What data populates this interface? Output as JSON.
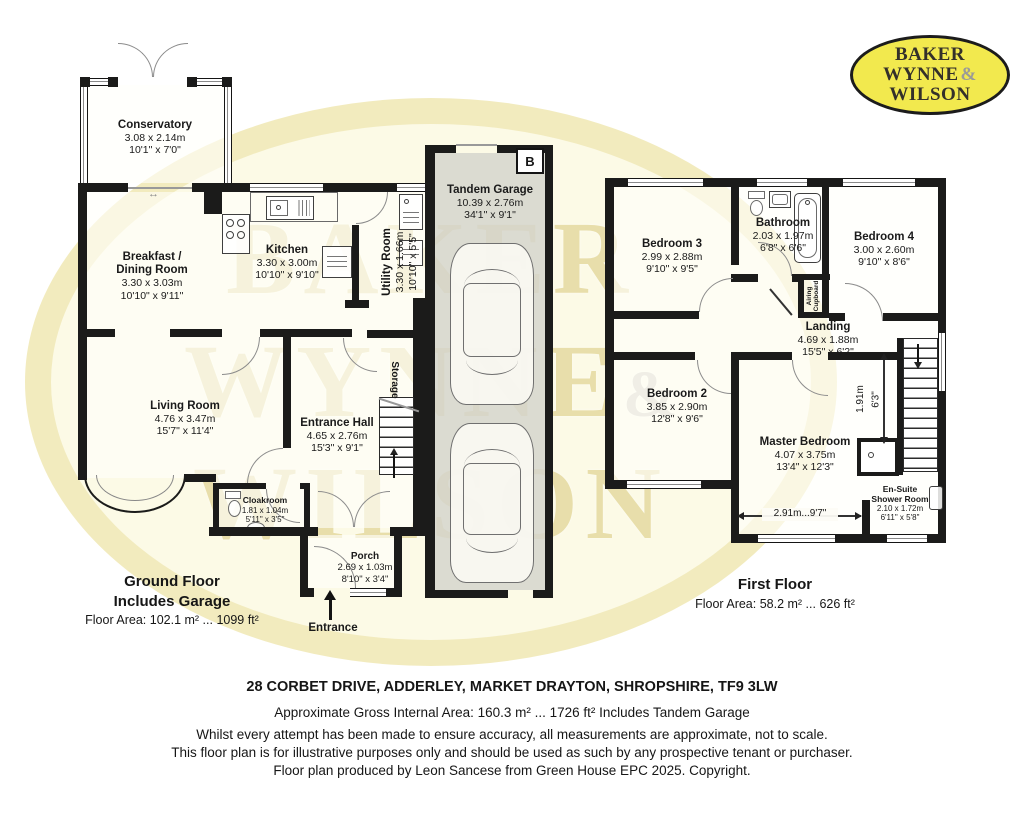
{
  "logo": {
    "line1": "BAKER",
    "line2": "WYNNE",
    "ampersand": "&",
    "line3": "WILSON"
  },
  "watermark": {
    "line1": "BAKER",
    "line2": "WYNNE",
    "ampersand": "&",
    "line3": "WILSON"
  },
  "ground_floor": {
    "title": "Ground Floor",
    "subtitle": "Includes Garage",
    "area": "Floor Area: 102.1 m² ... 1099 ft²",
    "entrance_label": "Entrance",
    "storage_label": "Storage",
    "boiler_label": "B",
    "sliding_door_icon": "↔",
    "rooms": [
      {
        "name": "Conservatory",
        "dim_m": "3.08 x 2.14m",
        "dim_ft": "10'1\" x 7'0\""
      },
      {
        "name": "Breakfast /\nDining Room",
        "dim_m": "3.30 x 3.03m",
        "dim_ft": "10'10\" x 9'11\""
      },
      {
        "name": "Kitchen",
        "dim_m": "3.30 x 3.00m",
        "dim_ft": "10'10\" x 9'10\""
      },
      {
        "name": "Utility Room",
        "dim_m": "3.30 x 1.66m",
        "dim_ft": "10'10\" x 5'5\""
      },
      {
        "name": "Living Room",
        "dim_m": "4.76 x 3.47m",
        "dim_ft": "15'7\" x 11'4\""
      },
      {
        "name": "Entrance Hall",
        "dim_m": "4.65 x 2.76m",
        "dim_ft": "15'3\" x 9'1\""
      },
      {
        "name": "Cloakroom",
        "dim_m": "1.81 x 1.04m",
        "dim_ft": "5'11\" x 3'5\""
      },
      {
        "name": "Porch",
        "dim_m": "2.69 x 1.03m",
        "dim_ft": "8'10\" x 3'4\""
      },
      {
        "name": "Tandem Garage",
        "dim_m": "10.39 x 2.76m",
        "dim_ft": "34'1\" x 9'1\""
      }
    ]
  },
  "first_floor": {
    "title": "First Floor",
    "area": "Floor Area: 58.2 m² ... 626 ft²",
    "airing_label": "Airing\nCupboard",
    "dim_vertical_m": "1.91m",
    "dim_vertical_ft": "6'3\"",
    "dim_horizontal": "2.91m...9'7\"",
    "rooms": [
      {
        "name": "Bedroom 3",
        "dim_m": "2.99 x 2.88m",
        "dim_ft": "9'10\" x 9'5\""
      },
      {
        "name": "Bathroom",
        "dim_m": "2.03 x 1.97m",
        "dim_ft": "6'8\" x 6'6\""
      },
      {
        "name": "Bedroom 4",
        "dim_m": "3.00 x 2.60m",
        "dim_ft": "9'10\" x 8'6\""
      },
      {
        "name": "Landing",
        "dim_m": "4.69 x 1.88m",
        "dim_ft": "15'5\" x 6'2\""
      },
      {
        "name": "Bedroom 2",
        "dim_m": "3.85 x 2.90m",
        "dim_ft": "12'8\" x 9'6\""
      },
      {
        "name": "Master Bedroom",
        "dim_m": "4.07 x 3.75m",
        "dim_ft": "13'4\" x 12'3\""
      },
      {
        "name": "En-Suite\nShower Room",
        "dim_m": "2.10 x 1.72m",
        "dim_ft": "6'11\" x 5'8\""
      }
    ]
  },
  "footer": {
    "address": "28 CORBET DRIVE, ADDERLEY, MARKET DRAYTON, SHROPSHIRE, TF9 3LW",
    "gross_area": "Approximate Gross Internal Area: 160.3 m² ... 1726 ft² Includes Tandem Garage",
    "disclaimer_line1": "Whilst every attempt has been made to ensure accuracy, all measurements are approximate, not to scale.",
    "disclaimer_line2": "This floor plan is for illustrative purposes only and should be used as such by any prospective tenant or purchaser.",
    "copyright": "Floor plan produced by Leon Sancese from Green House EPC 2025. Copyright."
  }
}
